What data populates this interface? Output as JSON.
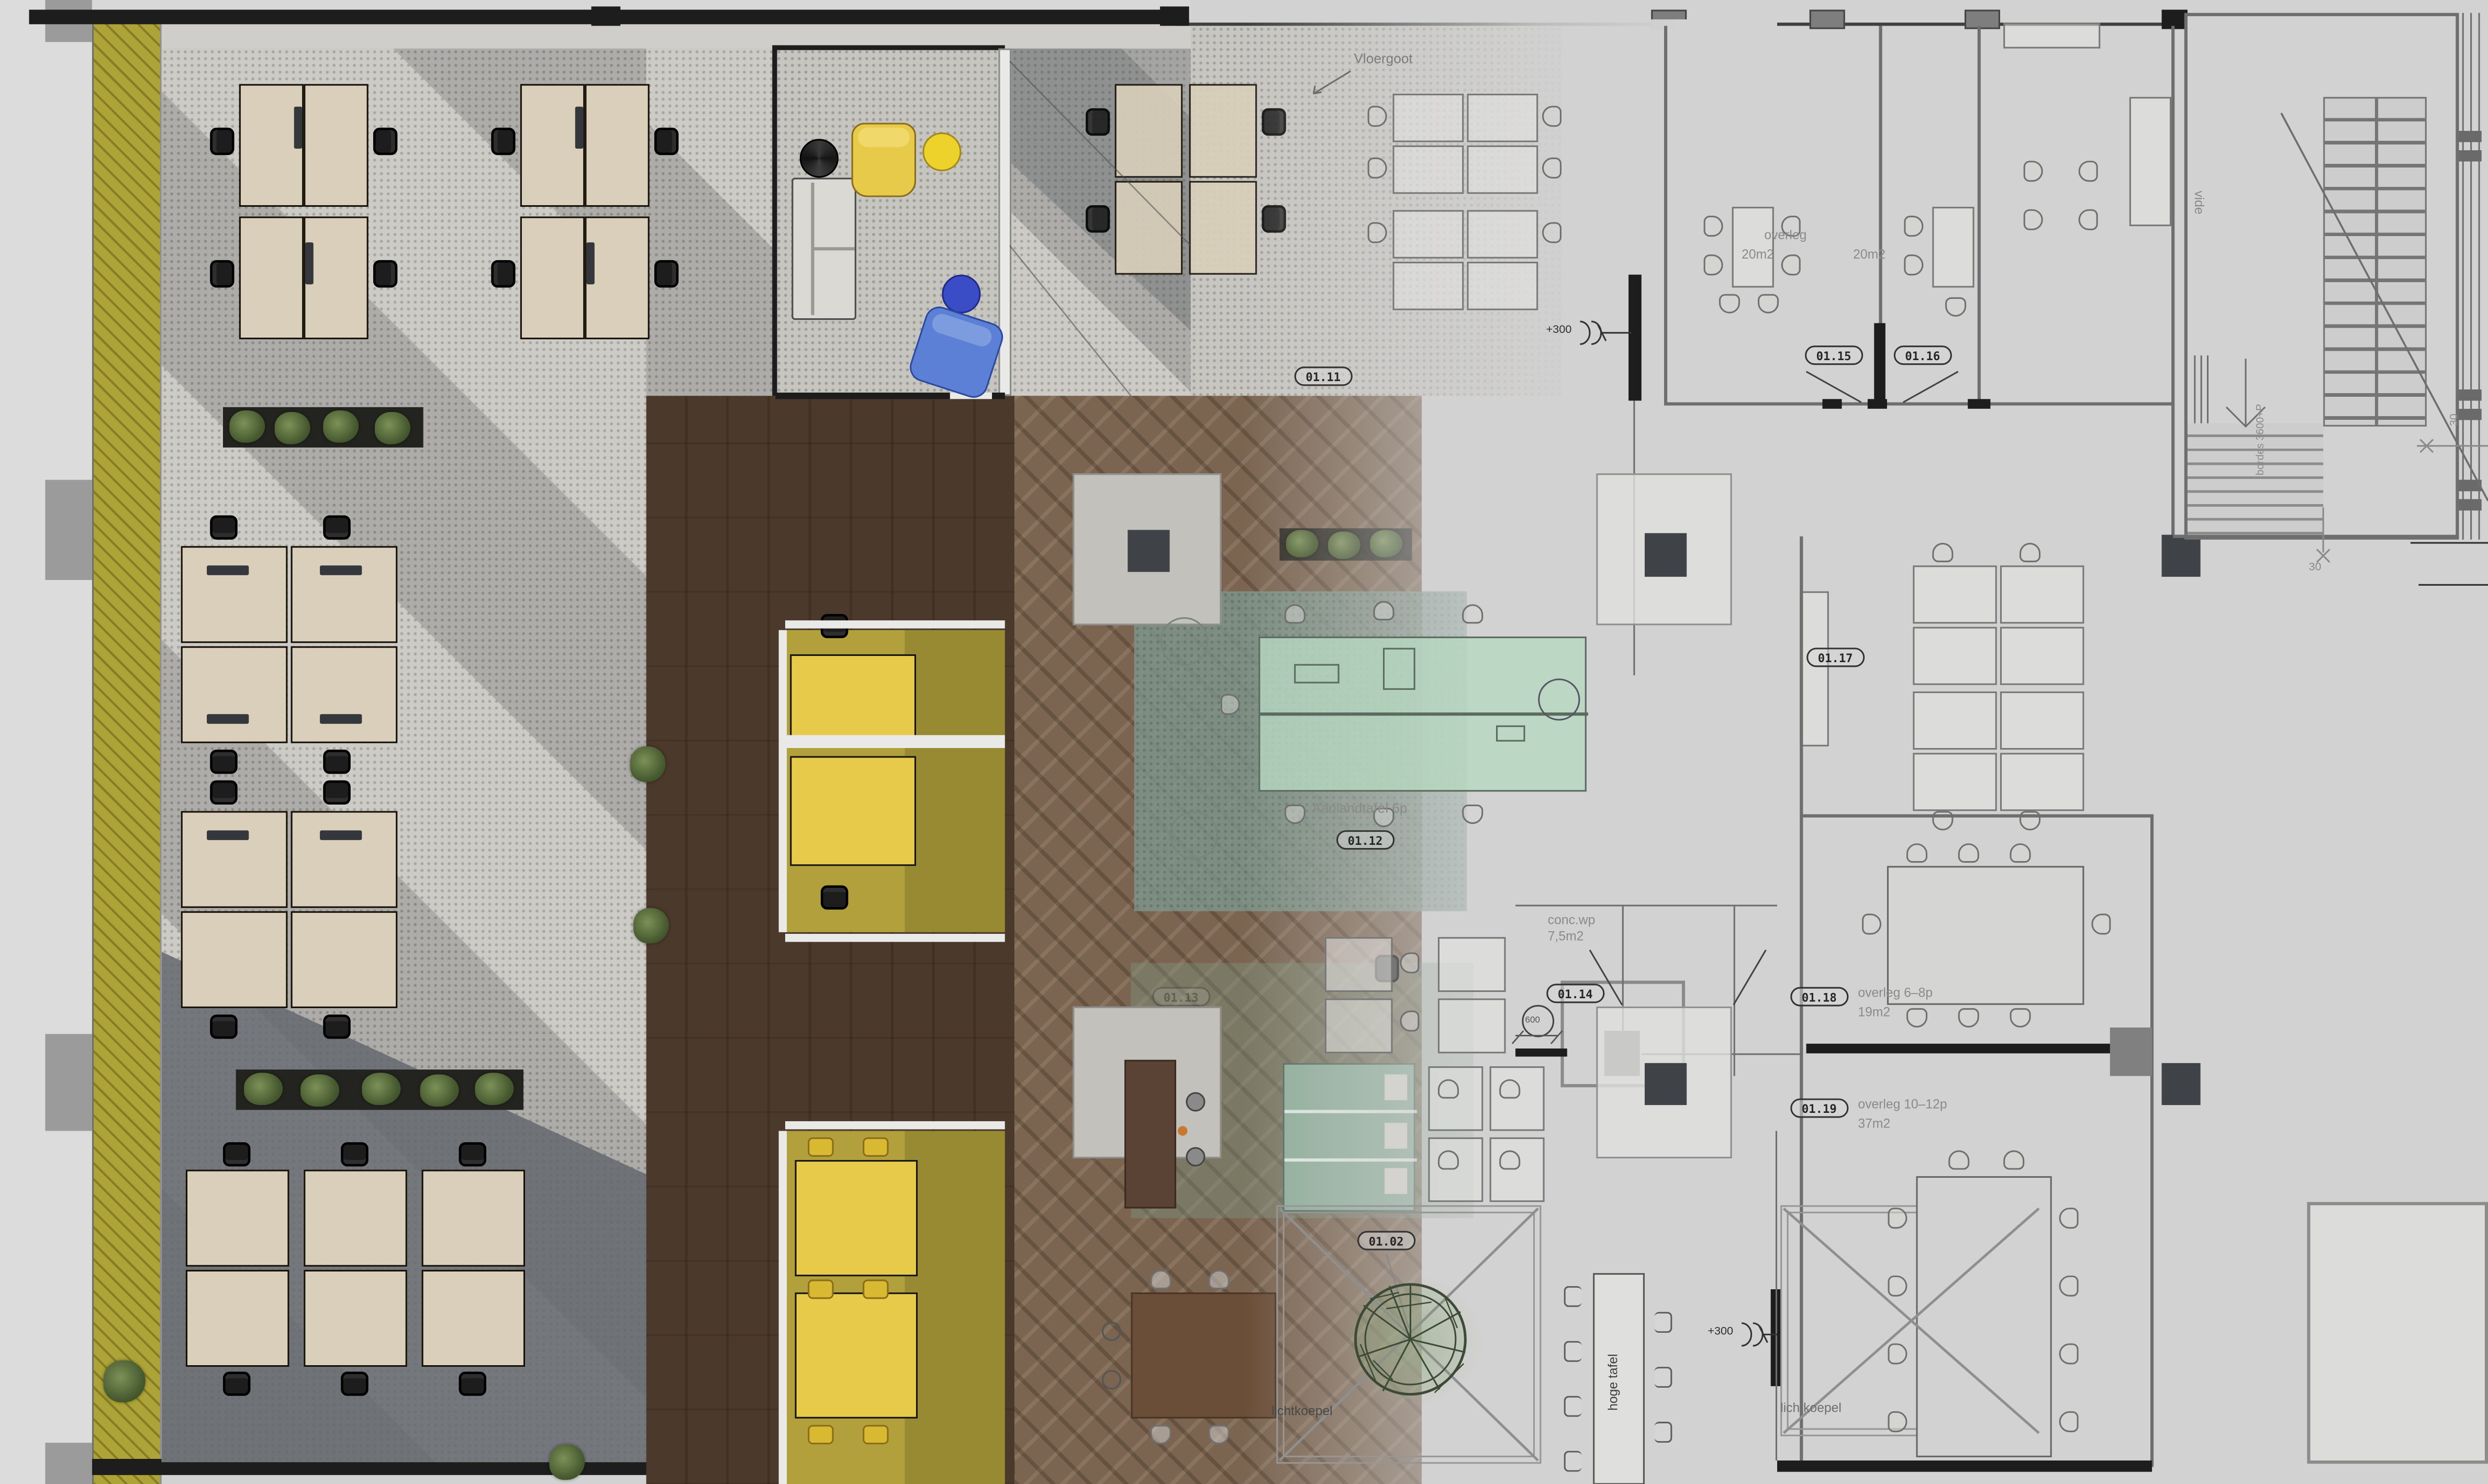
{
  "colors": {
    "cad_bg": "#d2d2d2",
    "cad_line": "#6e6e6e",
    "wall_dark": "#1d1d1d",
    "label_gray": "#8a8a8a",
    "badge_ink": "#262626",
    "facade_yellow": "#aea337",
    "carpet": "#c7c5c0",
    "carpet_dark": "#64686e",
    "wood_dark": "#4b392b",
    "wood_mid": "#7b6551",
    "desk_top": "#d9cfba",
    "chair_dark": "#1d1d1d",
    "rug_olive": "#b1a03c",
    "accent_yellow": "#e8ca4a",
    "accent_yellow_bright": "#ecd22b",
    "accent_blue": "#3a4cc6",
    "accent_blue_light": "#5b80d6",
    "glass_green": "#b7d8c2",
    "teal_rug": "#7e978d",
    "booth_green": "#8fae9b",
    "sofa_gray": "#dbd9d3",
    "white_wall": "#e9e9e7",
    "counter_brown": "#5a4234",
    "plant_green": "#55693c",
    "tile_gray": "#c3c1bc",
    "column_dark": "#3f4246"
  },
  "labels": {
    "vloergoot": "Vloergoot",
    "overleg_top": "overleg",
    "area_room_a": "20m2",
    "area_room_b": "20m2",
    "vide": "vide",
    "bordes": "bordes 3600+P",
    "dim_30_right": "30",
    "dim_30_bottom": "30",
    "dim_600": "600",
    "level_top": "+300",
    "level_bottom": "+300",
    "aanlandtafel": "Aanlandtafel 6p",
    "conc_wp": "conc.wp",
    "conc_wp_area": "7,5m2",
    "overleg_68": "overleg 6–8p",
    "overleg_68_area": "19m2",
    "overleg_1012": "overleg 10–12p",
    "overleg_1012_area": "37m2",
    "lichtkoepel_left": "lichtkoepel",
    "lichtkoepel_right": "lichtkoepel",
    "hoge_tafel": "hoge tafel"
  },
  "badges": {
    "b0102": "01.02",
    "b0111": "01.11",
    "b0112": "01.12",
    "b0113": "01.13",
    "b0114": "01.14",
    "b0115": "01.15",
    "b0116": "01.16",
    "b0117": "01.17",
    "b0118": "01.18",
    "b0119": "01.19"
  }
}
